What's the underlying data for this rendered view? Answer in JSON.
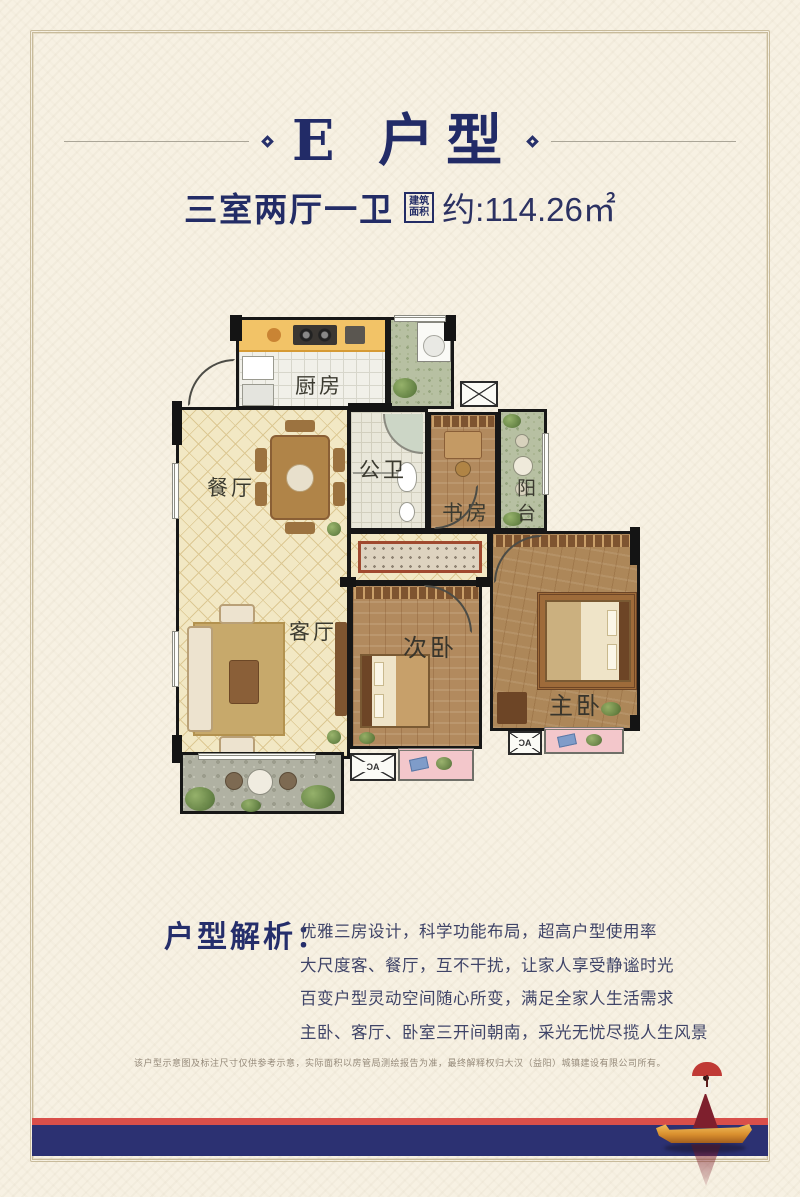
{
  "title": {
    "text": "E 户型"
  },
  "subtitle": {
    "rooms": "三室两厅一卫",
    "badge_top": "建筑",
    "badge_bottom": "面积",
    "area": "约:114.26㎡"
  },
  "floorplan": {
    "labels": {
      "kitchen": "厨房",
      "dining": "餐厅",
      "bath": "公卫",
      "study": "书房",
      "balcony": "阳台",
      "living": "客厅",
      "bedroom2": "次卧",
      "master": "主卧"
    },
    "ac_label": "AC"
  },
  "analysis": {
    "heading": "户型解析：",
    "lines": [
      "优雅三房设计，科学功能布局，超高户型使用率",
      "大尺度客、餐厅，互不干扰，让家人享受静谧时光",
      "百变户型灵动空间随心所变，满足全家人生活需求",
      "主卧、客厅、卧室三开间朝南，采光无忧尽揽人生风景"
    ]
  },
  "disclaimer": "该户型示意图及标注尺寸仅供参考示意，实际面积以房管局测绘报告为准，最终解释权归大汉（益阳）城镇建设有限公司所有。",
  "colors": {
    "accent_navy": "#232c66",
    "band_navy": "#2c3172",
    "band_red": "#d94f4a",
    "balcony_pink": "#f3c7cb",
    "wood": "#b28a5e",
    "tile_cream": "#f2e8c4",
    "wall_black": "#171717"
  }
}
